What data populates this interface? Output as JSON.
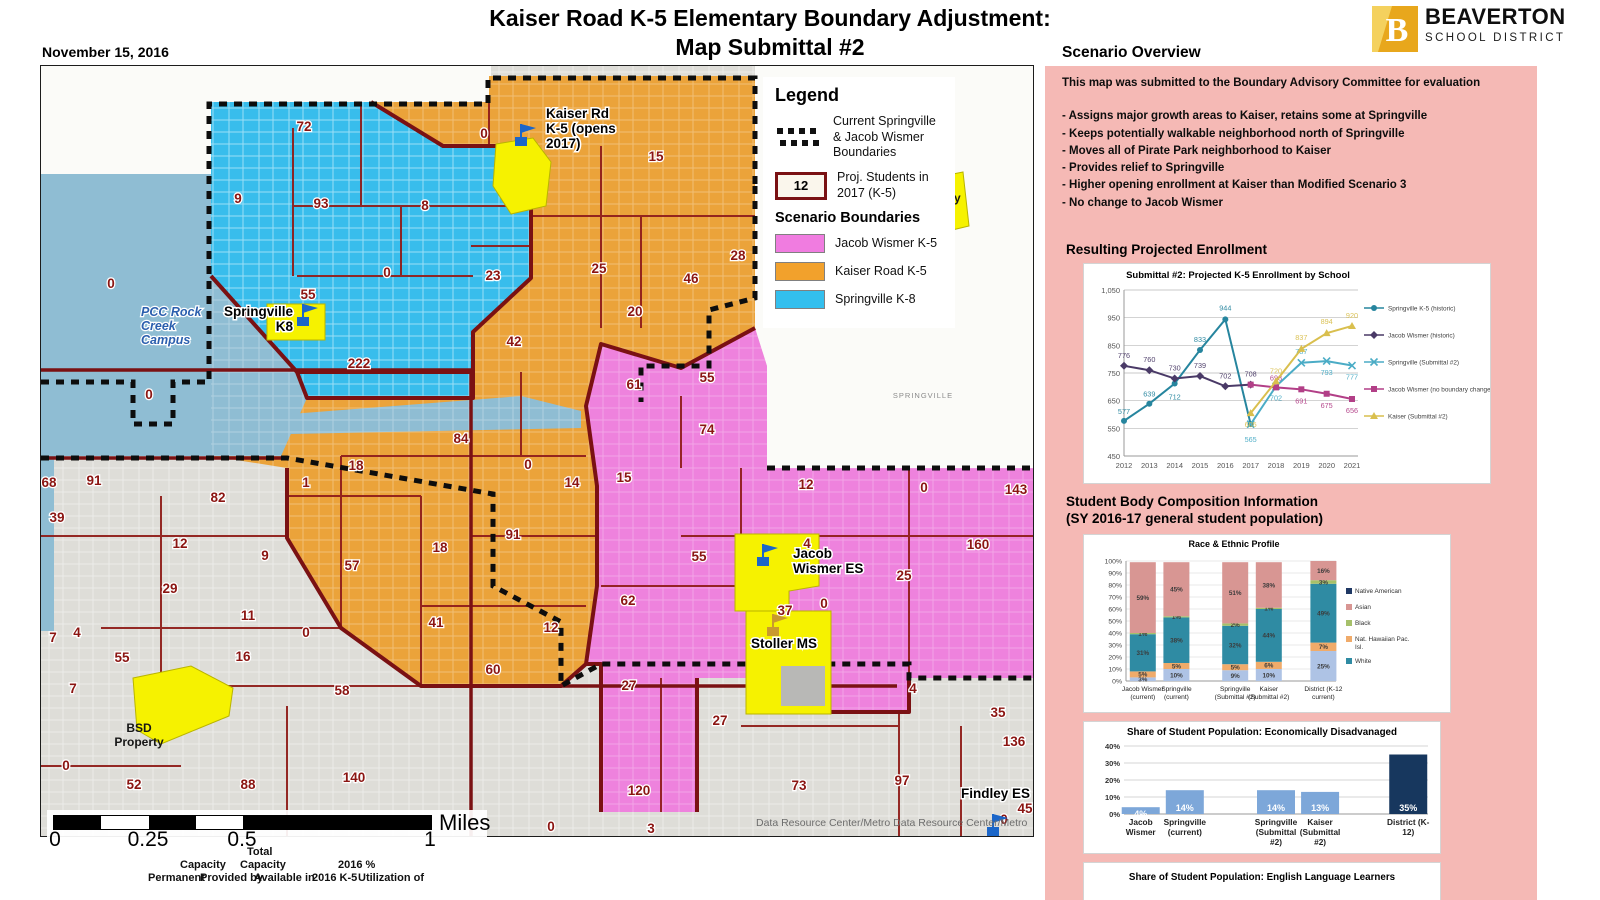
{
  "date_label": "November 15, 2016",
  "title": {
    "line1": "Kaiser Road K-5 Elementary Boundary Adjustment:",
    "line2": "Map Submittal #2"
  },
  "logo": {
    "name": "BEAVERTON",
    "sub": "SCHOOL DISTRICT",
    "mark_color": "#e8a71c",
    "mark_color2": "#f4d15e"
  },
  "overview": {
    "heading": "Scenario Overview",
    "intro": "This map was submitted to the Boundary Advisory Committee for evaluation",
    "bullets": [
      "- Assigns major growth areas to Kaiser, retains some at Springville",
      "- Keeps potentially walkable neighborhood north of Springville",
      "- Moves all of Pirate Park neighborhood to Kaiser",
      "- Provides relief to Springville",
      "- Higher opening enrollment at Kaiser than Modified Scenario 3",
      "- No change to Jacob Wismer"
    ]
  },
  "enrollment_heading": "Resulting Projected Enrollment",
  "composition_heading": {
    "line1": "Student Body Composition Information",
    "line2": "(SY 2016-17 general student population)"
  },
  "map": {
    "legend": {
      "heading": "Legend",
      "current_label": "Current Springville & Jacob Wismer Boundaries",
      "proj_value": "12",
      "proj_label": "Proj. Students in 2017 (K-5)",
      "scenario_heading": "Scenario Boundaries",
      "zones": [
        {
          "label": "Jacob Wismer K-5",
          "color": "#f07ce0"
        },
        {
          "label": "Kaiser Road K-5",
          "color": "#f2a12c"
        },
        {
          "label": "Springville K-8",
          "color": "#33bfee"
        }
      ]
    },
    "region_labels": [
      [
        "72",
        263,
        65
      ],
      [
        "9",
        197,
        137
      ],
      [
        "93",
        280,
        142
      ],
      [
        "8",
        384,
        144
      ],
      [
        "0",
        346,
        211
      ],
      [
        "55",
        267,
        233
      ],
      [
        "222",
        318,
        302
      ],
      [
        "0",
        70,
        222
      ],
      [
        "0",
        108,
        333
      ],
      [
        "0",
        443,
        72
      ],
      [
        "15",
        615,
        95
      ],
      [
        "23",
        452,
        214
      ],
      [
        "25",
        558,
        207
      ],
      [
        "46",
        650,
        217
      ],
      [
        "28",
        697,
        194
      ],
      [
        "20",
        594,
        250
      ],
      [
        "42",
        473,
        280
      ],
      [
        "84",
        420,
        377
      ],
      [
        "18",
        315,
        404
      ],
      [
        "1",
        265,
        421
      ],
      [
        "0",
        487,
        403
      ],
      [
        "14",
        531,
        421
      ],
      [
        "9",
        224,
        494
      ],
      [
        "91",
        472,
        473
      ],
      [
        "18",
        399,
        486
      ],
      [
        "57",
        311,
        504
      ],
      [
        "41",
        395,
        561
      ],
      [
        "12",
        510,
        566
      ],
      [
        "60",
        452,
        608
      ],
      [
        "0",
        265,
        571
      ],
      [
        "61",
        593,
        323
      ],
      [
        "55",
        666,
        316
      ],
      [
        "74",
        666,
        368
      ],
      [
        "15",
        583,
        416
      ],
      [
        "12",
        765,
        423
      ],
      [
        "0",
        883,
        426
      ],
      [
        "143",
        975,
        428
      ],
      [
        "160",
        937,
        483
      ],
      [
        "4",
        766,
        482
      ],
      [
        "25",
        863,
        514
      ],
      [
        "55",
        658,
        495
      ],
      [
        "62",
        587,
        539
      ],
      [
        "37",
        744,
        549
      ],
      [
        "0",
        783,
        542
      ],
      [
        "27",
        588,
        624
      ],
      [
        "120",
        598,
        729
      ],
      [
        "68",
        8,
        421
      ],
      [
        "91",
        53,
        419
      ],
      [
        "82",
        177,
        436
      ],
      [
        "39",
        16,
        456
      ],
      [
        "12",
        139,
        482
      ],
      [
        "29",
        129,
        527
      ],
      [
        "11",
        207,
        554
      ],
      [
        "16",
        202,
        595
      ],
      [
        "55",
        81,
        596
      ],
      [
        "4",
        36,
        571
      ],
      [
        "7",
        12,
        576
      ],
      [
        "7",
        32,
        627
      ],
      [
        "0",
        25,
        704
      ],
      [
        "52",
        93,
        723
      ],
      [
        "88",
        207,
        723
      ],
      [
        "140",
        313,
        716
      ],
      [
        "58",
        301,
        629
      ],
      [
        "27",
        679,
        659
      ],
      [
        "73",
        758,
        724
      ],
      [
        "97",
        861,
        719
      ],
      [
        "4",
        872,
        627
      ],
      [
        "35",
        957,
        651
      ],
      [
        "136",
        973,
        680
      ],
      [
        "45",
        984,
        747
      ],
      [
        "0",
        963,
        758
      ],
      [
        "0",
        510,
        765
      ],
      [
        "3",
        610,
        767
      ]
    ],
    "schools": [
      {
        "label": "Springville K8",
        "lines": [
          "Springville",
          "K8"
        ],
        "x": 252,
        "y": 250,
        "anchor": "end",
        "flag": [
          262,
          238
        ],
        "fc": "#1b66c9"
      },
      {
        "label": "Kaiser Rd K-5 (opens 2017)",
        "lines": [
          "Kaiser Rd",
          "K-5 (opens",
          "2017)"
        ],
        "x": 505,
        "y": 52,
        "anchor": "start",
        "flag": [
          480,
          58
        ],
        "fc": "#1b66c9"
      },
      {
        "label": "Jacob Wismer ES",
        "lines": [
          "Jacob",
          "Wismer ES"
        ],
        "x": 752,
        "y": 492,
        "anchor": "start",
        "flag": [
          722,
          478
        ],
        "fc": "#1b66c9"
      },
      {
        "label": "Stoller MS",
        "lines": [
          "Stoller MS"
        ],
        "x": 710,
        "y": 582,
        "anchor": "start",
        "flag": [
          732,
          548
        ],
        "fc": "#c99a2e"
      },
      {
        "label": "Findley ES",
        "lines": [
          "Findley ES"
        ],
        "x": 920,
        "y": 732,
        "anchor": "start",
        "flag": [
          952,
          748
        ],
        "fc": "#1b66c9"
      }
    ],
    "places": [
      {
        "lines": [
          "PCC Rock",
          "Creek",
          "Campus"
        ],
        "x": 100,
        "y": 250,
        "cls": "pcc"
      },
      {
        "lines": [
          "BSD",
          "Property"
        ],
        "x": 895,
        "y": 122,
        "cls": "bsd"
      },
      {
        "lines": [
          "BSD",
          "Property"
        ],
        "x": 98,
        "y": 666,
        "cls": "bsd"
      },
      {
        "lines": [
          "SPRINGVILLE"
        ],
        "x": 882,
        "y": 332,
        "cls": "road"
      }
    ],
    "attribution": "Data Resource Center/Metro Data Resource Center/Metro",
    "scale": {
      "segments": [
        47,
        48,
        47,
        47,
        188
      ],
      "labels": [
        {
          "t": "0",
          "x": 8
        },
        {
          "t": "0.25",
          "x": 101
        },
        {
          "t": "0.5",
          "x": 195
        },
        {
          "t": "1",
          "x": 383
        }
      ],
      "unit": "Miles"
    }
  },
  "capacity_fragment": [
    {
      "t": "Total",
      "x": 247,
      "y": 846
    },
    {
      "t": "Capacity",
      "x": 180,
      "y": 859
    },
    {
      "t": "Capacity",
      "x": 240,
      "y": 859
    },
    {
      "t": "2016 %",
      "x": 338,
      "y": 859
    },
    {
      "t": "Permanent",
      "x": 148,
      "y": 872
    },
    {
      "t": "Provided by",
      "x": 200,
      "y": 872
    },
    {
      "t": "Available in",
      "x": 254,
      "y": 872
    },
    {
      "t": "2016 K-5",
      "x": 312,
      "y": 872
    },
    {
      "t": "Utilization of",
      "x": 358,
      "y": 872
    }
  ],
  "chart_data": [
    {
      "id": "enrollment",
      "type": "line",
      "title": "Submittal #2: Projected K-5 Enrollment by School",
      "x": [
        2012,
        2013,
        2014,
        2015,
        2016,
        2017,
        2018,
        2019,
        2020,
        2021
      ],
      "ylim": [
        450,
        1050
      ],
      "ytick": 100,
      "grid": true,
      "legend_position": "right",
      "series": [
        {
          "name": "Springville K-5 (historic)",
          "color": "#26859e",
          "marker": "circle",
          "start": 2012,
          "values": [
            577,
            639,
            712,
            833,
            944,
            565
          ],
          "ldy": [
            -7,
            -7,
            16,
            -8,
            -9,
            0
          ],
          "lshow": [
            1,
            1,
            1,
            1,
            1,
            0
          ]
        },
        {
          "name": "Jacob Wismer (historic)",
          "color": "#4a3a67",
          "marker": "diamond",
          "start": 2012,
          "values": [
            776,
            760,
            730,
            739,
            702,
            708
          ],
          "ldy": [
            -8,
            -8,
            -8,
            -8,
            -8,
            -8
          ],
          "lshow": [
            1,
            1,
            1,
            1,
            1,
            1
          ]
        },
        {
          "name": "Springville (Submittal #2)",
          "color": "#4bacc6",
          "marker": "x",
          "start": 2017,
          "values": [
            565,
            702,
            787,
            793,
            777
          ],
          "ldy": [
            18,
            14,
            -9,
            14,
            14
          ],
          "lshow": [
            1,
            1,
            1,
            1,
            1
          ]
        },
        {
          "name": "Jacob Wismer (no boundary change)",
          "color": "#b23f87",
          "marker": "square",
          "start": 2017,
          "values": [
            708,
            698,
            691,
            675,
            656
          ],
          "ldy": [
            0,
            -7,
            14,
            14,
            14
          ],
          "lshow": [
            0,
            1,
            1,
            1,
            1
          ]
        },
        {
          "name": "Kaiser (Submittal #2)",
          "color": "#d9bf4e",
          "marker": "tri",
          "start": 2017,
          "values": [
            605,
            720,
            837,
            894,
            920
          ],
          "ldy": [
            14,
            -8,
            -9,
            -9,
            -8
          ],
          "lshow": [
            1,
            1,
            1,
            1,
            1
          ]
        }
      ]
    },
    {
      "id": "race",
      "type": "stacked-bar",
      "title": "Race & Ethnic Profile",
      "categories": [
        [
          "Jacob Wismer",
          "(current)"
        ],
        [
          "Springville",
          "(current)"
        ],
        [
          "Springville",
          "(Submittal #2)"
        ],
        [
          "Kaiser",
          "(Submittal #2)"
        ],
        [
          "District (K-12",
          "current)"
        ]
      ],
      "ylim": [
        0,
        100
      ],
      "series": [
        {
          "color": "#aec3e5",
          "values": [
            3,
            10,
            9,
            10,
            25
          ]
        },
        {
          "color": "#f0ab6a",
          "values": [
            5,
            5,
            5,
            6,
            7
          ]
        },
        {
          "color": "#2f8ba3",
          "values": [
            31,
            38,
            32,
            44,
            49
          ]
        },
        {
          "color": "#a6c06a",
          "values": [
            1,
            1,
            2,
            1,
            3
          ]
        },
        {
          "color": "#d89693",
          "values": [
            59,
            45,
            51,
            38,
            16
          ]
        }
      ],
      "legend": [
        {
          "label": "Native American",
          "color": "#1f3864"
        },
        {
          "label": "Asian",
          "color": "#d89693"
        },
        {
          "label": "Black",
          "color": "#a6c06a"
        },
        {
          "label": "Nat. Hawaiian Pac. Isl.",
          "color": "#f0ab6a"
        },
        {
          "label": "White",
          "color": "#2f8ba3"
        }
      ]
    },
    {
      "id": "econ",
      "type": "bar",
      "title": "Share of Student Population: Economically Disadvanaged",
      "categories": [
        [
          "Jacob",
          "Wismer"
        ],
        [
          "Springville",
          "(current)"
        ],
        [
          "Springville",
          "(Submittal",
          "#2)"
        ],
        [
          "Kaiser",
          "(Submittal",
          "#2)"
        ],
        [
          "District (K-",
          "12)"
        ]
      ],
      "values": [
        4,
        14,
        14,
        13,
        35
      ],
      "labels": [
        "4%",
        "14%",
        "14%",
        "13%",
        "35%"
      ],
      "bar_color": "#7da7d9",
      "district_color": "#17375e",
      "ylim": [
        0,
        40
      ]
    },
    {
      "id": "ell",
      "type": "bar",
      "title": "Share of Student Population: English Language Learners",
      "ylim": [
        0,
        20
      ],
      "visible_tick": "20%"
    }
  ]
}
